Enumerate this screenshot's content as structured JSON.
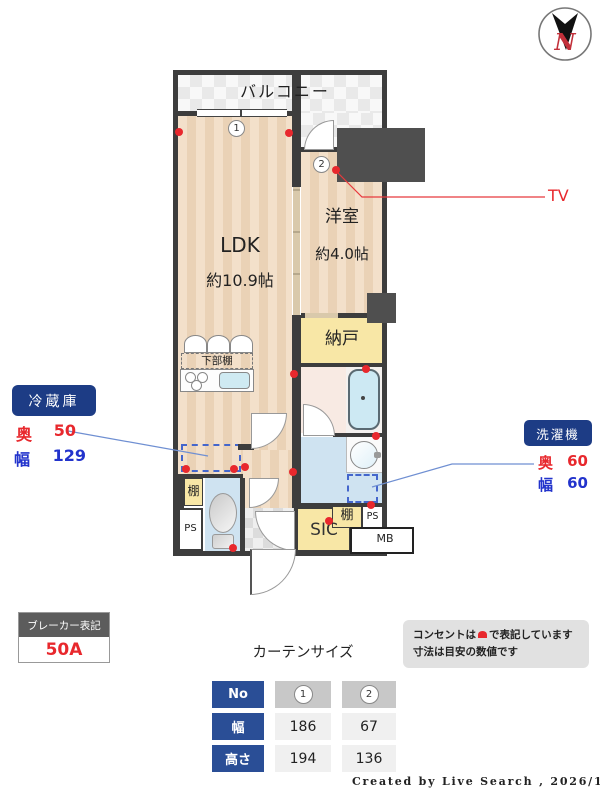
{
  "compass": {
    "n": "N"
  },
  "plan": {
    "balcony": "バルコニー",
    "ldk": "LDK",
    "ldk_size": "約10.9帖",
    "western_room": "洋室",
    "western_room_size": "約4.0帖",
    "storage": "納戸",
    "lower_shelf": "下部棚",
    "shelf_left": "棚",
    "shelf_right": "棚",
    "ps_left": "PS",
    "ps_right": "PS",
    "sic": "SIC",
    "mb": "MB",
    "win1": "1",
    "win2": "2"
  },
  "labels": {
    "tv": "TV",
    "fridge_title": "冷蔵庫",
    "fridge_depth_label": "奥",
    "fridge_depth": "50",
    "fridge_width_label": "幅",
    "fridge_width": "129",
    "washer_title": "洗濯機",
    "washer_depth_label": "奥",
    "washer_depth": "60",
    "washer_width_label": "幅",
    "washer_width": "60",
    "breaker_title": "ブレーカー表記",
    "breaker_value": "50A",
    "note_line1_pre": "コンセントは",
    "note_line1_post": "で表記しています",
    "note_line2": "寸法は目安の数値です"
  },
  "curtain": {
    "title": "カーテンサイズ",
    "rows": [
      {
        "label": "No",
        "c1": "1",
        "c2": "2"
      },
      {
        "label": "幅",
        "c1": "186",
        "c2": "67"
      },
      {
        "label": "高さ",
        "c1": "194",
        "c2": "136"
      }
    ]
  },
  "credit": "Created by Live Search , 2026/1",
  "colors": {
    "accent_red": "#e8282d",
    "accent_blue": "#2233cc",
    "badge_navy": "#1d3c85",
    "table_navy": "#2a4e96",
    "leader_blue": "#6f8fd2",
    "wall": "#3d3d3d"
  }
}
